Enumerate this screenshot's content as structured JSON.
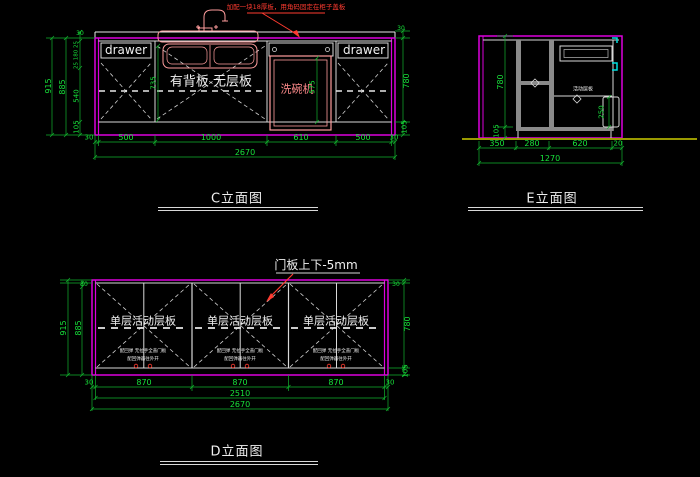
{
  "colors": {
    "background": "#000000",
    "cabinet_outline": "#dd00dd",
    "linework": "#e8e8e8",
    "dimension": "#17e23a",
    "annotation_red": "#ff3b30",
    "fixture_pink": "#ff8c8c",
    "hardware_cyan": "#00e0e0",
    "ground_olive": "#9a9a00"
  },
  "views": {
    "c": {
      "title": "C立面图",
      "note": "加配一块18厚板，用角码固定在柜子盖板",
      "labels": {
        "drawer_left": "drawer",
        "drawer_right": "drawer",
        "cabinet": "有背板 无层板",
        "dishwasher": "洗碗机"
      },
      "dims": {
        "outer_h": "915",
        "inner_h": "885",
        "top_left": "30",
        "drawer_stack": "25 180 25",
        "mid_left": "540",
        "toe_left": "105",
        "opening": "735",
        "dishwasher_h": "575",
        "top_right": "30",
        "right_h": "780",
        "toe_right": "105",
        "bottom": [
          "30",
          "500",
          "1000",
          "610",
          "500",
          "30"
        ],
        "total": "2670"
      }
    },
    "e": {
      "title": "E立面图",
      "labels": {
        "shelf": "活动层板"
      },
      "dims": {
        "height": "780",
        "toe": "105",
        "box": "250",
        "bottom": [
          "350",
          "280",
          "620",
          "20"
        ],
        "total": "1270"
      }
    },
    "d": {
      "title": "D立面图",
      "note": "门板上下-5mm",
      "panel_label": "单层活动层板",
      "panel_sub1": "配回弹 无拉手全盖门板",
      "panel_sub2": "配回弹器往外开",
      "dims": {
        "top_left": "30",
        "outer_h": "915",
        "inner_h": "885",
        "top_right": "30",
        "right_h": "780",
        "toe_right": "105",
        "bottom": [
          "30",
          "870",
          "870",
          "870",
          "30"
        ],
        "inner_total": "2510",
        "total": "2670"
      }
    }
  }
}
